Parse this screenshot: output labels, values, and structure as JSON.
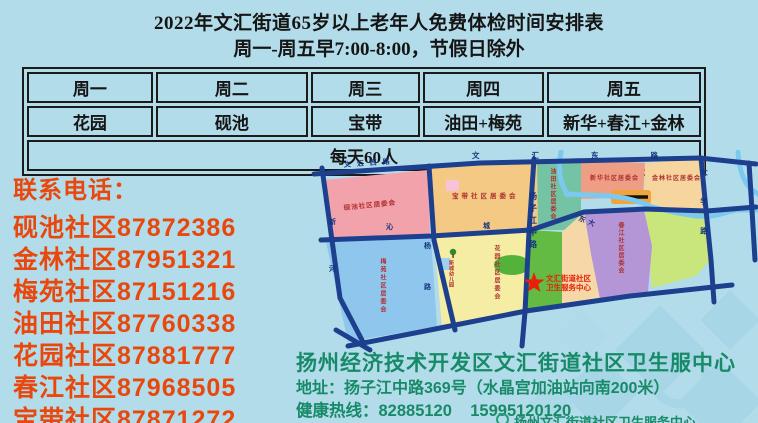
{
  "title": {
    "line1": "2022年文汇街道65岁以上老年人免费体检时间安排表",
    "line2": "周一-周五早7:00-8:00，节假日除外"
  },
  "table": {
    "headers": [
      "周一",
      "周二",
      "周三",
      "周四",
      "周五"
    ],
    "row": [
      "花园",
      "砚池",
      "宝带",
      "油田+梅苑",
      "新华+春江+金林"
    ],
    "note": "每天60人"
  },
  "contacts": {
    "heading": "联系电话：",
    "lines": [
      "砚池社区87872386",
      "金林社区87951321",
      "梅苑社区87151216",
      "油田社区87760338",
      "花园社区87881777",
      "春江社区87968505",
      "宝带社区87871272"
    ]
  },
  "clinic": {
    "name": "扬州经济技术开发区文汇街道社区卫生服中心",
    "address": "地址：扬子江中路369号（水晶宫加油站向南200米）",
    "hotline": "健康热线：82885120    15995120120",
    "footer": "扬州文汇街道社区卫生服务中心"
  },
  "map": {
    "marker": {
      "line1": "文汇街道社区",
      "line2": "卫生服务中心"
    },
    "regions": [
      {
        "name": "yanchi",
        "label": "砚池社区居委会",
        "color": "#f2a2aa"
      },
      {
        "name": "baodai",
        "label": "宝带社区居委会",
        "color": "#f3c983"
      },
      {
        "name": "youtian",
        "label": "油田社区居委会",
        "color": "#74c3a4"
      },
      {
        "name": "xinhua",
        "label": "新华社区居委会",
        "color": "#ef9e86"
      },
      {
        "name": "jinlin",
        "label": "金林社区居委会",
        "color": "#f6d69e"
      },
      {
        "name": "chunjiang",
        "label": "春江社区居委会",
        "color": "#b496d6"
      },
      {
        "name": "meiyuan",
        "label": "梅苑社区居委会",
        "color": "#8ec6ee"
      },
      {
        "name": "huayuan",
        "label": "花园社区居委会",
        "color": "#f6eda5"
      }
    ],
    "roads": [
      {
        "name": "wenhui-west",
        "label": "文汇西路"
      },
      {
        "name": "wenhui-east",
        "label": "文汇东路"
      },
      {
        "name": "yangzijiang",
        "label": "扬子江中路"
      },
      {
        "name": "xinhe",
        "label": "新河"
      },
      {
        "name": "yang-lu",
        "label": "杨路"
      },
      {
        "name": "qin",
        "label": "沁"
      },
      {
        "name": "cheng",
        "label": "城"
      },
      {
        "name": "dongda",
        "label": "东大"
      },
      {
        "name": "daxue",
        "label": "大学路"
      }
    ],
    "poi": {
      "kindergarten": "新城幼儿园"
    }
  }
}
